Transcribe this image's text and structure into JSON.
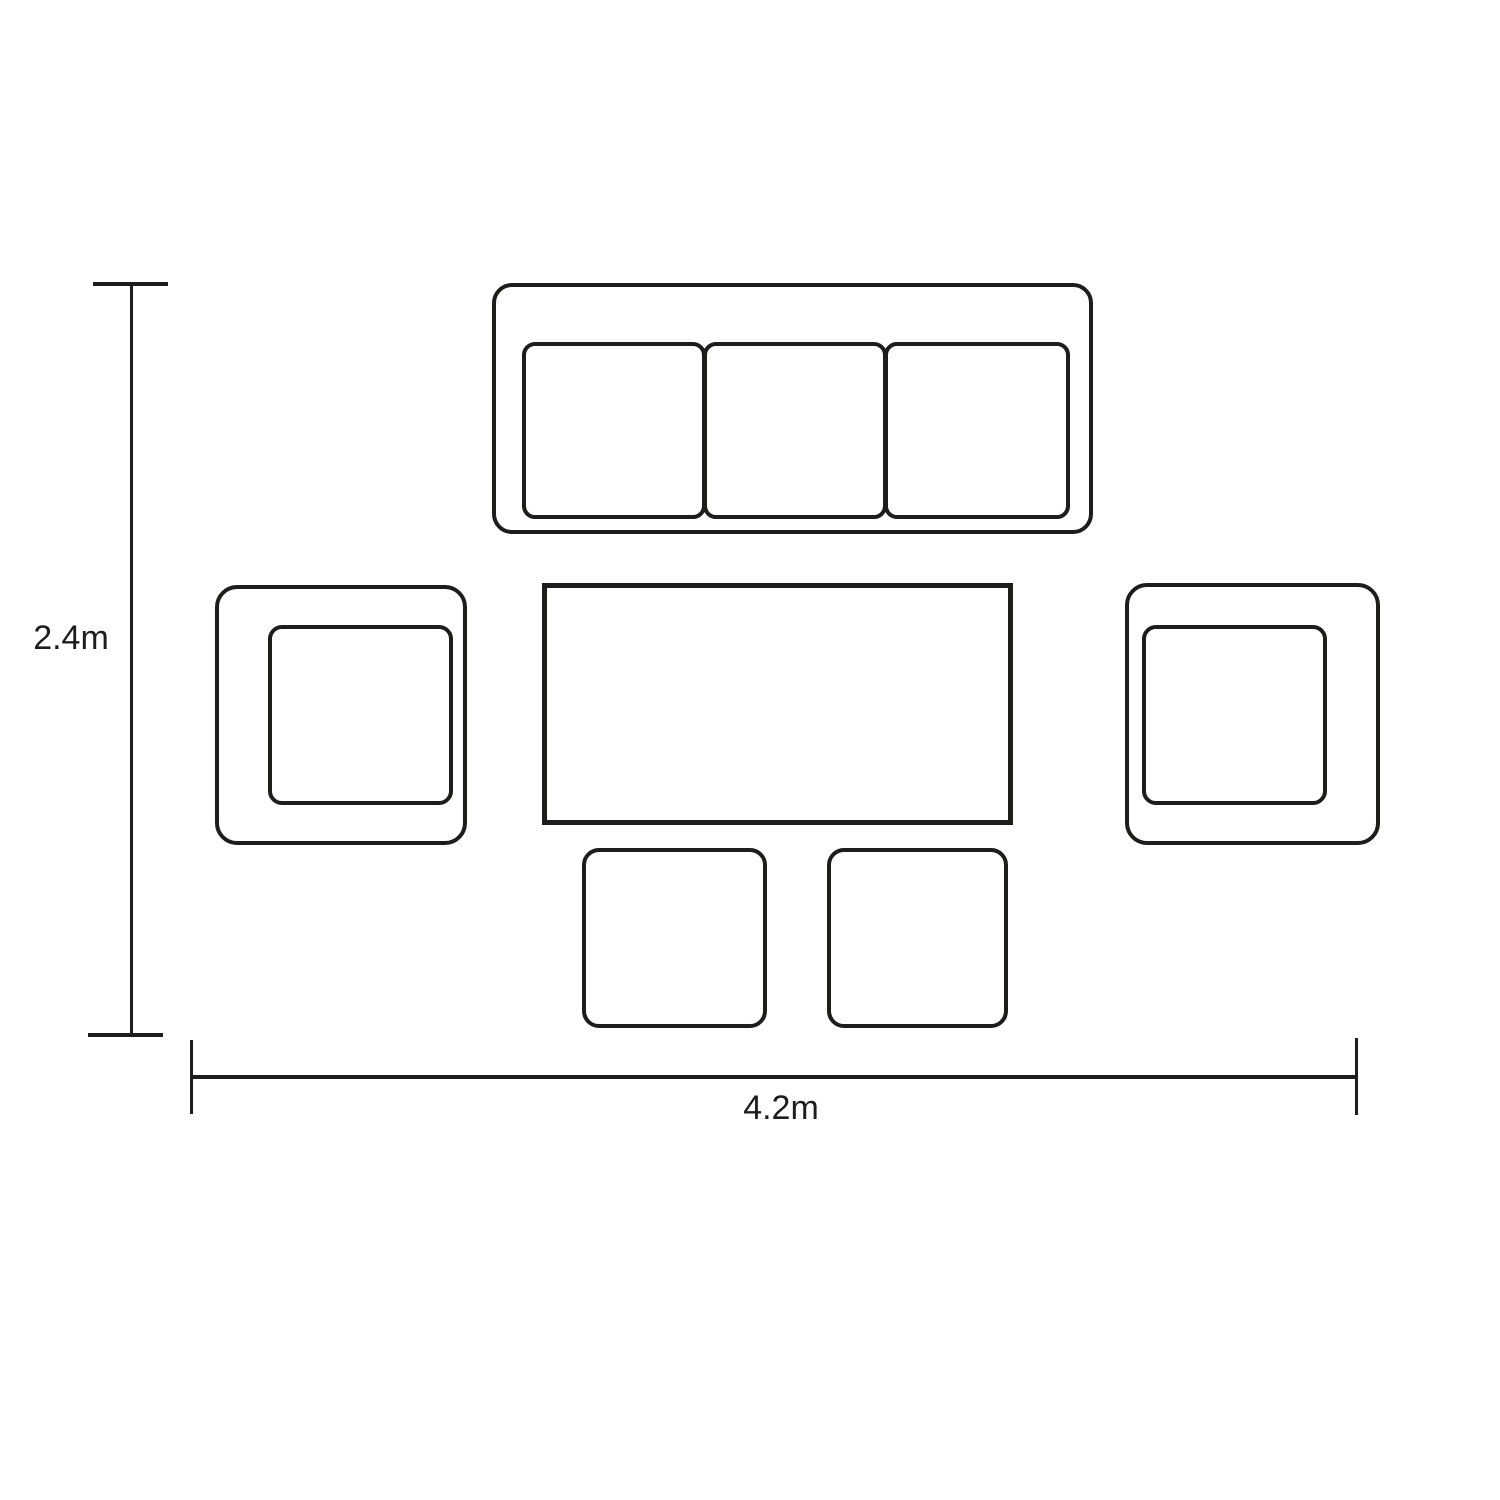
{
  "diagram": {
    "type": "furniture-layout-dimension-plan",
    "line_color": "#1d1d1b",
    "background_color": "#ffffff",
    "dimensions": {
      "height_label": "2.4m",
      "width_label": "4.2m"
    },
    "items": [
      {
        "name": "sofa-3-seater",
        "cushions": 3
      },
      {
        "name": "armchair-left"
      },
      {
        "name": "armchair-right"
      },
      {
        "name": "table"
      },
      {
        "name": "stool-left"
      },
      {
        "name": "stool-right"
      }
    ]
  }
}
